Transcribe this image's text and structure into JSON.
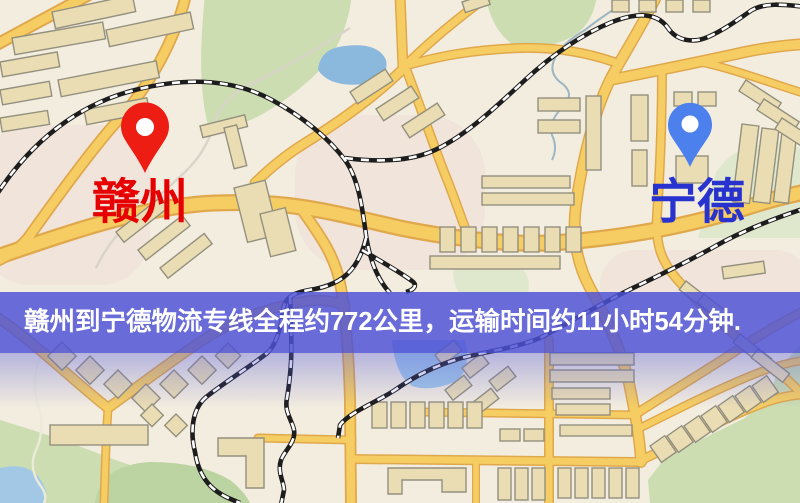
{
  "banner": {
    "text": "赣州到宁德物流专线全程约772公里，运输时间约11小时54分钟.",
    "background_color": "rgba(77,82,214,0.84)",
    "text_color": "#ffffff"
  },
  "markers": {
    "origin": {
      "label": "赣州",
      "pin_color": "#ee1d14",
      "label_color": "#e60000"
    },
    "destination": {
      "label": "宁德",
      "pin_color": "#4c80ec",
      "label_color": "#2732cf"
    }
  },
  "map": {
    "colors": {
      "background": "#f3eddf",
      "road_fill": "#f6cd63",
      "road_casing": "#e0a84c",
      "railway_dark": "#1d1d1d",
      "railway_light": "#ffffff",
      "park_green": "#ccddb2",
      "pale_green": "#dfe8cd",
      "water_blue": "#a2c8e6",
      "pond_blue": "#8bb9de",
      "building_fill": "#eaddb4",
      "building_stroke": "#94907e"
    }
  }
}
